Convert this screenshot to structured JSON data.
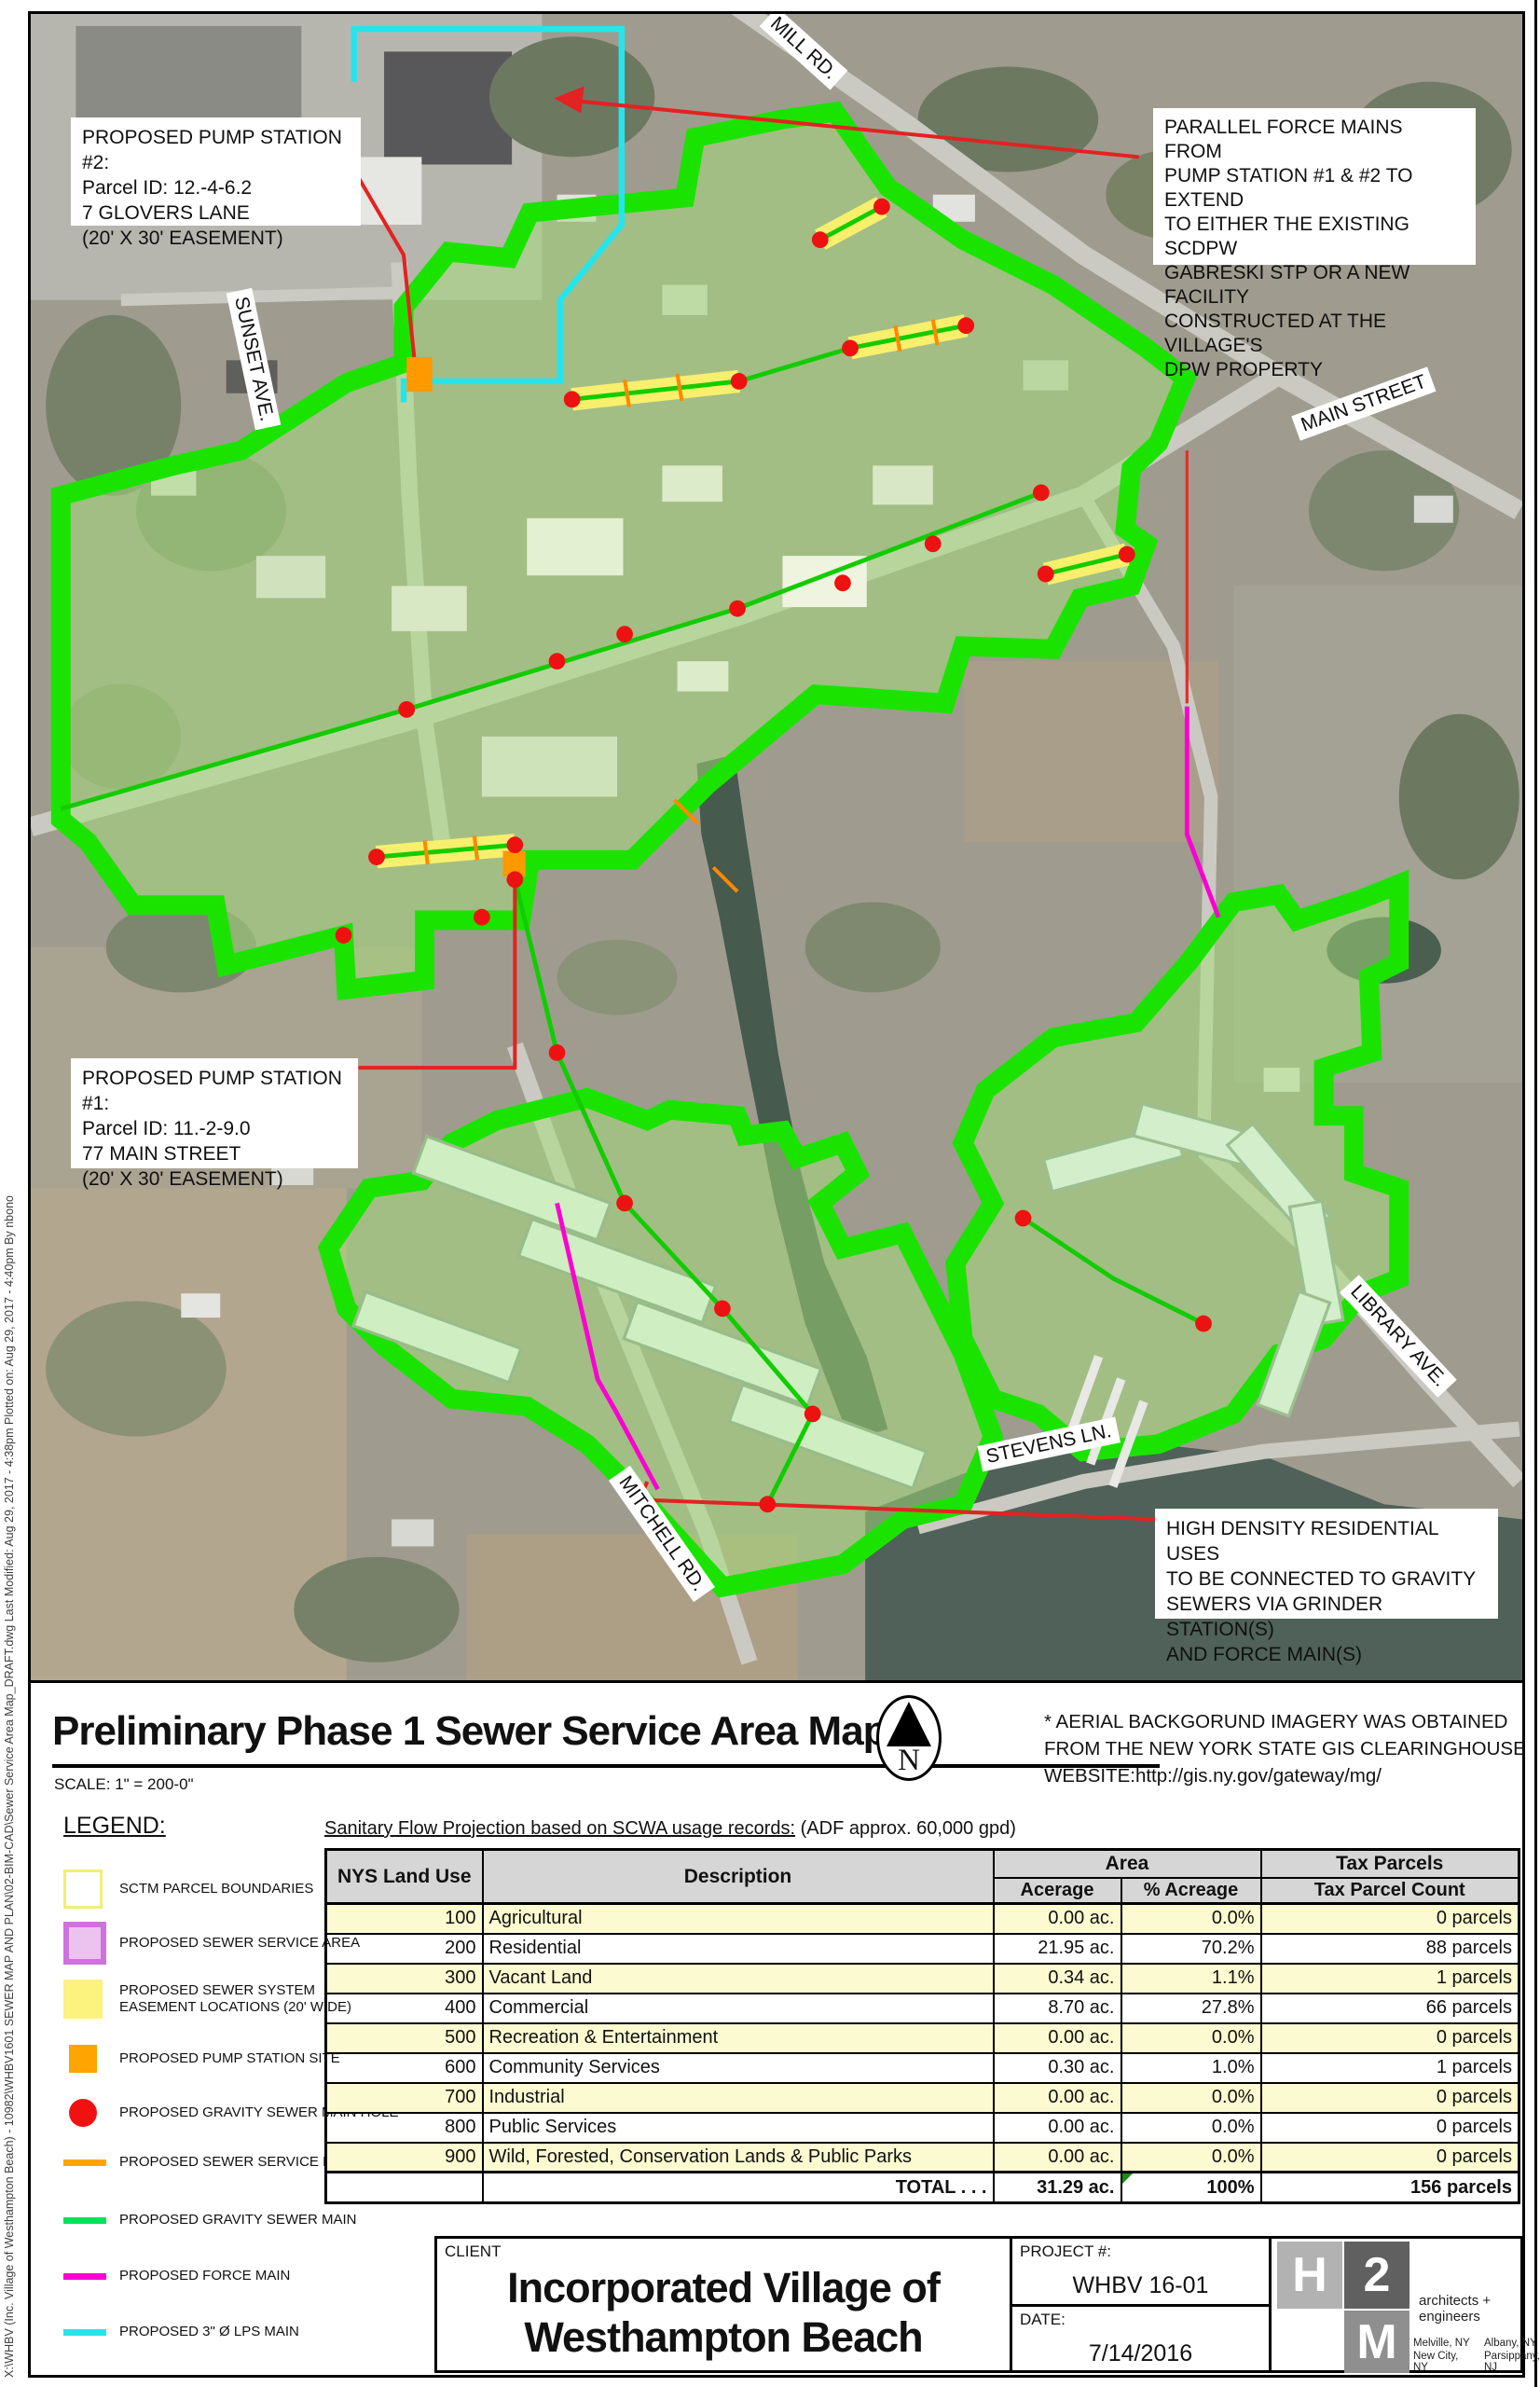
{
  "sheet": {
    "plot_info": "X:\\WHBV (Inc. Village of Westhampton Beach) - 10982\\WHBV1601 SEWER MAP AND PLAN\\02-BIM-CAD\\Sewer Service Area Map_DRAFT.dwg Last Modified: Aug 29, 2017 - 4:38pm Plotted on: Aug 29, 2017 - 4:40pm By nbono"
  },
  "map": {
    "street_labels": [
      {
        "text": "MILL RD."
      },
      {
        "text": "MAIN STREET"
      },
      {
        "text": "SUNSET AVE."
      },
      {
        "text": "LIBRARY AVE."
      },
      {
        "text": "STEVENS LN."
      },
      {
        "text": "MITCHELL RD."
      }
    ],
    "annotations": [
      {
        "text": "PROPOSED PUMP STATION #2:\nParcel ID: 12.-4-6.2\n7 GLOVERS LANE\n(20' X 30' EASEMENT)"
      },
      {
        "text": "PARALLEL FORCE MAINS FROM\nPUMP STATION #1 & #2 TO EXTEND\nTO EITHER THE EXISTING SCDPW\nGABRESKI STP OR A NEW  FACILITY\nCONSTRUCTED AT THE VILLAGE'S\nDPW PROPERTY"
      },
      {
        "text": "PROPOSED PUMP STATION #1:\nParcel ID: 11.-2-9.0\n77 MAIN STREET\n(20' X 30' EASEMENT)"
      },
      {
        "text": "HIGH DENSITY RESIDENTIAL USES\nTO BE CONNECTED TO GRAVITY\nSEWERS VIA GRINDER STATION(S)\nAND FORCE MAIN(S)"
      }
    ]
  },
  "title_bar": {
    "title": "Preliminary Phase 1 Sewer Service Area Map",
    "scale": "SCALE: 1\" = 200-0\"",
    "north_label": "N",
    "aerial_note": "* AERIAL BACKGORUND IMAGERY WAS OBTAINED\nFROM THE NEW YORK STATE GIS CLEARINGHOUSE\nWEBSITE:http://gis.ny.gov/gateway/mg/"
  },
  "legend": {
    "heading": "LEGEND:",
    "items": [
      {
        "label": "SCTM PARCEL  BOUNDARIES",
        "swatch": "square",
        "color": "#ffffff",
        "border": "#f2ee76"
      },
      {
        "label": "PROPOSED SEWER SERVICE AREA",
        "swatch": "square",
        "color": "#ecc3ee",
        "border": "#cf72dd"
      },
      {
        "label": "PROPOSED SEWER SYSTEM\nEASEMENT LOCATIONS (20' WIDE)",
        "swatch": "square",
        "color": "#fcf27e",
        "border": "#fcf27e"
      },
      {
        "label": "PROPOSED PUMP STATION SITE",
        "swatch": "square",
        "color": "#ffa400",
        "border": "#ffa400"
      },
      {
        "label": "PROPOSED GRAVITY SEWER MAIN HOLE",
        "swatch": "circle",
        "color": "#f01212",
        "border": "#f01212"
      },
      {
        "label": "PROPOSED SEWER SERVICE LATERAL",
        "swatch": "line",
        "color": "#ffa400",
        "border": "#ffa400"
      },
      {
        "label": "PROPOSED GRAVITY SEWER MAIN",
        "swatch": "line",
        "color": "#00e25c",
        "border": "#00e25c"
      },
      {
        "label": "PROPOSED FORCE MAIN",
        "swatch": "line",
        "color": "#fb00d0",
        "border": "#fb00d0"
      },
      {
        "label": "PROPOSED 3\" Ø LPS MAIN",
        "swatch": "line",
        "color": "#27e4ec",
        "border": "#27e4ec"
      }
    ]
  },
  "table": {
    "caption_underlined": "Sanitary Flow Projection based on SCWA usage records:",
    "caption_rest": " (ADF approx. 60,000 gpd)",
    "headers": {
      "land_use": "NYS Land Use",
      "description": "Description",
      "area_group": "Area",
      "tax_group": "Tax Parcels",
      "acerage": "Acerage",
      "pct_acreage": "% Acreage",
      "tax_parcel_count": "Tax Parcel Count"
    },
    "rows": [
      {
        "code": "100",
        "description": "Agricultural",
        "acerage": "0.00 ac.",
        "pct": "0.0%",
        "parcels": "0 parcels"
      },
      {
        "code": "200",
        "description": "Residential",
        "acerage": "21.95 ac.",
        "pct": "70.2%",
        "parcels": "88 parcels"
      },
      {
        "code": "300",
        "description": "Vacant Land",
        "acerage": "0.34 ac.",
        "pct": "1.1%",
        "parcels": "1 parcels"
      },
      {
        "code": "400",
        "description": "Commercial",
        "acerage": "8.70 ac.",
        "pct": "27.8%",
        "parcels": "66 parcels"
      },
      {
        "code": "500",
        "description": "Recreation & Entertainment",
        "acerage": "0.00 ac.",
        "pct": "0.0%",
        "parcels": "0 parcels"
      },
      {
        "code": "600",
        "description": "Community Services",
        "acerage": "0.30 ac.",
        "pct": "1.0%",
        "parcels": "1 parcels"
      },
      {
        "code": "700",
        "description": "Industrial",
        "acerage": "0.00 ac.",
        "pct": "0.0%",
        "parcels": "0 parcels"
      },
      {
        "code": "800",
        "description": "Public Services",
        "acerage": "0.00 ac.",
        "pct": "0.0%",
        "parcels": "0 parcels"
      },
      {
        "code": "900",
        "description": "Wild, Forested, Conservation Lands & Public Parks",
        "acerage": "0.00 ac.",
        "pct": "0.0%",
        "parcels": "0 parcels"
      }
    ],
    "total": {
      "label": "TOTAL . . .",
      "acerage": "31.29 ac.",
      "pct": "100%",
      "parcels": "156 parcels"
    }
  },
  "title_block": {
    "client_label": "CLIENT",
    "client_name": "Incorporated Village of\nWesthampton Beach",
    "project_label": "PROJECT #:",
    "project_number": "WHBV 16-01",
    "date_label": "DATE:",
    "date": "7/14/2016",
    "logo": {
      "h": "H",
      "two": "2",
      "m": "M",
      "tagline": "architects + engineers"
    },
    "offices": [
      "Melville, NY",
      "Albany, NY",
      "New City, NY",
      "Parsippany, NJ"
    ]
  },
  "colors": {
    "service_area_outline_green": "#1be300",
    "service_area_fill_green": "#a6e07a",
    "easement_yellow": "#f8ef6d",
    "pump_station_orange": "#ff9900",
    "manhole_red": "#ee1111",
    "force_main_magenta": "#fb00d0",
    "lps_main_cyan": "#27e4ec",
    "gravity_sewer_green": "#12cc00",
    "table_row_yellow": "#fcfad0",
    "table_header_gray": "#d6d6d6"
  }
}
